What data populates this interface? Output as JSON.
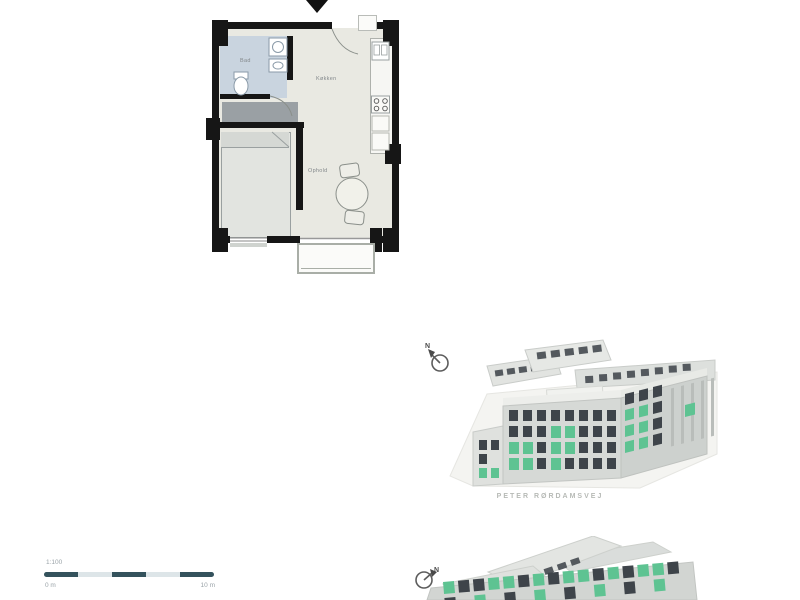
{
  "page": {
    "background": "#ffffff"
  },
  "floor_plan": {
    "bath_label": "Bad",
    "kitchen_label": "Køkken",
    "living_label": "Ophold"
  },
  "aerial_view_top": {
    "street_label": "PETER RØRDAMSVEJ",
    "north_label": "N"
  },
  "aerial_view_bottom": {
    "north_label": "N"
  },
  "scale_bar": {
    "scale_label": "1:100",
    "zero_label": "0 m",
    "end_label": "10 m"
  },
  "colors": {
    "wall": "#161616",
    "floor": "#e9e9e2",
    "bath_floor": "#c9d4df",
    "wardrobe": "#9aa0a4",
    "building_body": "#d6d9d6",
    "building_roof": "#edeeeb",
    "window_dark": "#3e444a",
    "window_green": "#5ec392",
    "scalebar_dark": "#34525c",
    "scalebar_light": "#dde5e8",
    "muted_text": "#b7bab6",
    "plan_text": "#84898c"
  }
}
